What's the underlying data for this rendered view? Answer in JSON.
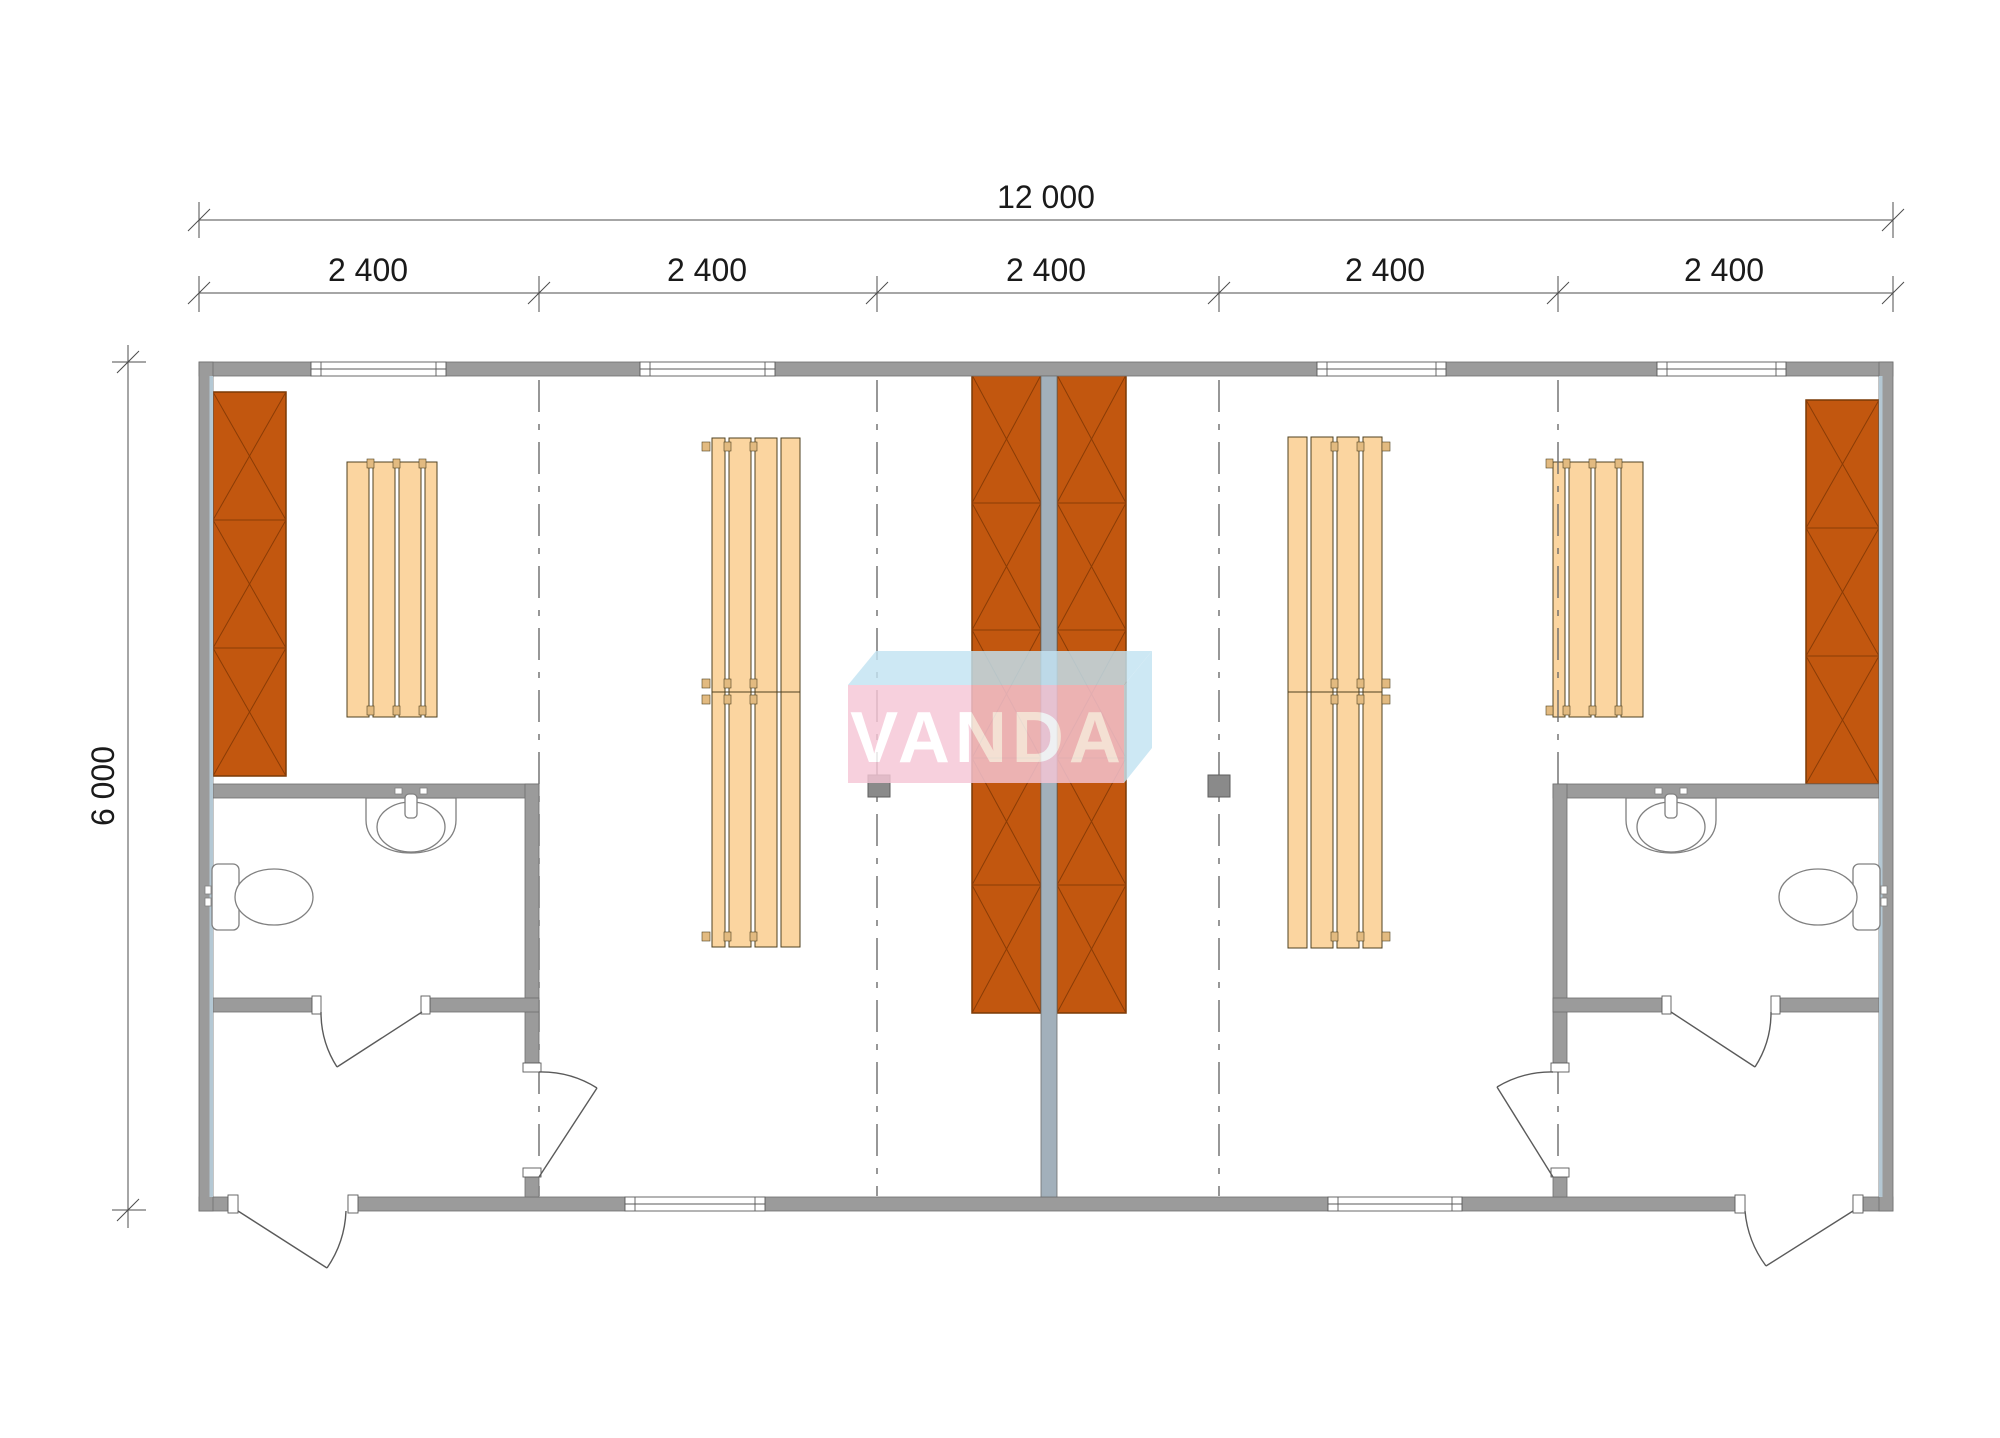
{
  "dimensions": {
    "total_width_label": "12 000",
    "segment_labels": [
      "2 400",
      "2 400",
      "2 400",
      "2 400",
      "2 400"
    ],
    "height_label": "6 000"
  },
  "watermark": {
    "text": "VANDA",
    "front_color": "#f6c6d6",
    "top_color": "#c3e3f2"
  },
  "colors": {
    "wall": "#9b9b9b",
    "wall_edge": "#6e6e6e",
    "partition_wall": "#a2b0bb",
    "insulation_liner": "#b4c8d4",
    "locker": "#c2570f",
    "locker_line": "#7a3a06",
    "bench": "#fbd5a0",
    "bench_line": "#4f4120",
    "bench_tab": "#e2ba80",
    "dash_line": "#6b6b6b",
    "fixture_outline": "#808080",
    "dimension_line": "#4d4d4d",
    "post": "#8a8a8a"
  },
  "plan": {
    "module_count": 5,
    "windows_count": 6,
    "doors_count": 6,
    "posts_count": 2,
    "lockers": [
      "locker-left",
      "locker-center-left",
      "locker-center-right",
      "locker-right"
    ],
    "benches": [
      "bench-1",
      "bench-2-double",
      "bench-3-double",
      "bench-4"
    ],
    "bathrooms": [
      {
        "name": "bathroom-left",
        "fixtures": [
          "toilet",
          "sink"
        ]
      },
      {
        "name": "bathroom-right",
        "fixtures": [
          "toilet",
          "sink"
        ]
      }
    ]
  }
}
